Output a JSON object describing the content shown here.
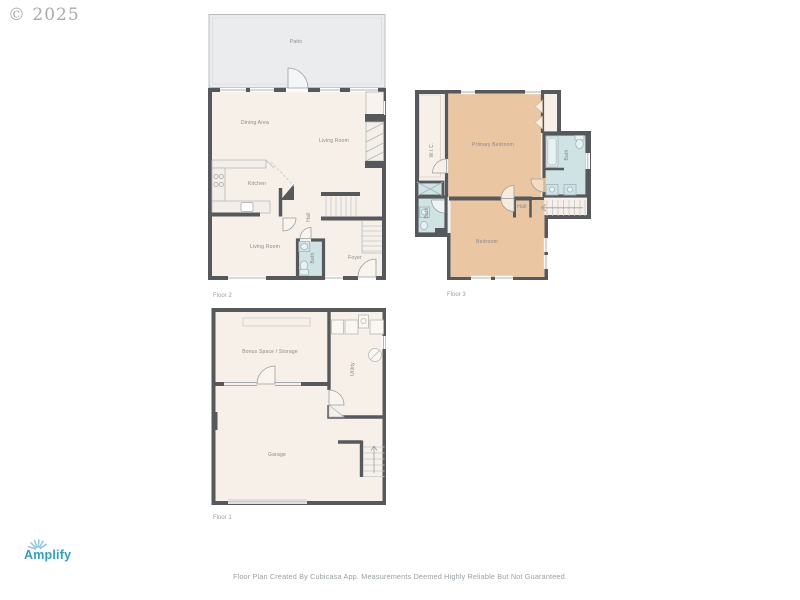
{
  "watermark": "© 2025",
  "floor2": {
    "label": "Floor 2",
    "patio": "Patio",
    "dining": "Dining Area",
    "living_upper": "Living Room",
    "kitchen": "Kitchen",
    "living_lower": "Living Room",
    "hall": "Hall",
    "bath": "Bath",
    "foyer": "Foyer"
  },
  "floor3": {
    "label": "Floor 3",
    "primary_bedroom": "Primary Bedroom",
    "wic": "W.I.C.",
    "bath_right": "Bath",
    "bath_left": "Bath",
    "bedroom": "Bedroom",
    "hall": "Hall"
  },
  "floor1": {
    "label": "Floor 1",
    "bonus": "Bonus Space / Storage",
    "utility": "Utility",
    "garage": "Garage"
  },
  "branding": {
    "logo_text": "Amplify"
  },
  "footer": "Floor Plan Created By Cubicasa App. Measurements Deemed Highly Reliable But Not Guaranteed.",
  "colors": {
    "wall": "#55595c",
    "floor": "#f6f0e9",
    "patio": "#eaecee",
    "bedroom": "#ebc6a3",
    "bath": "#cfe2e4",
    "logo_blue": "#2f9fca"
  }
}
